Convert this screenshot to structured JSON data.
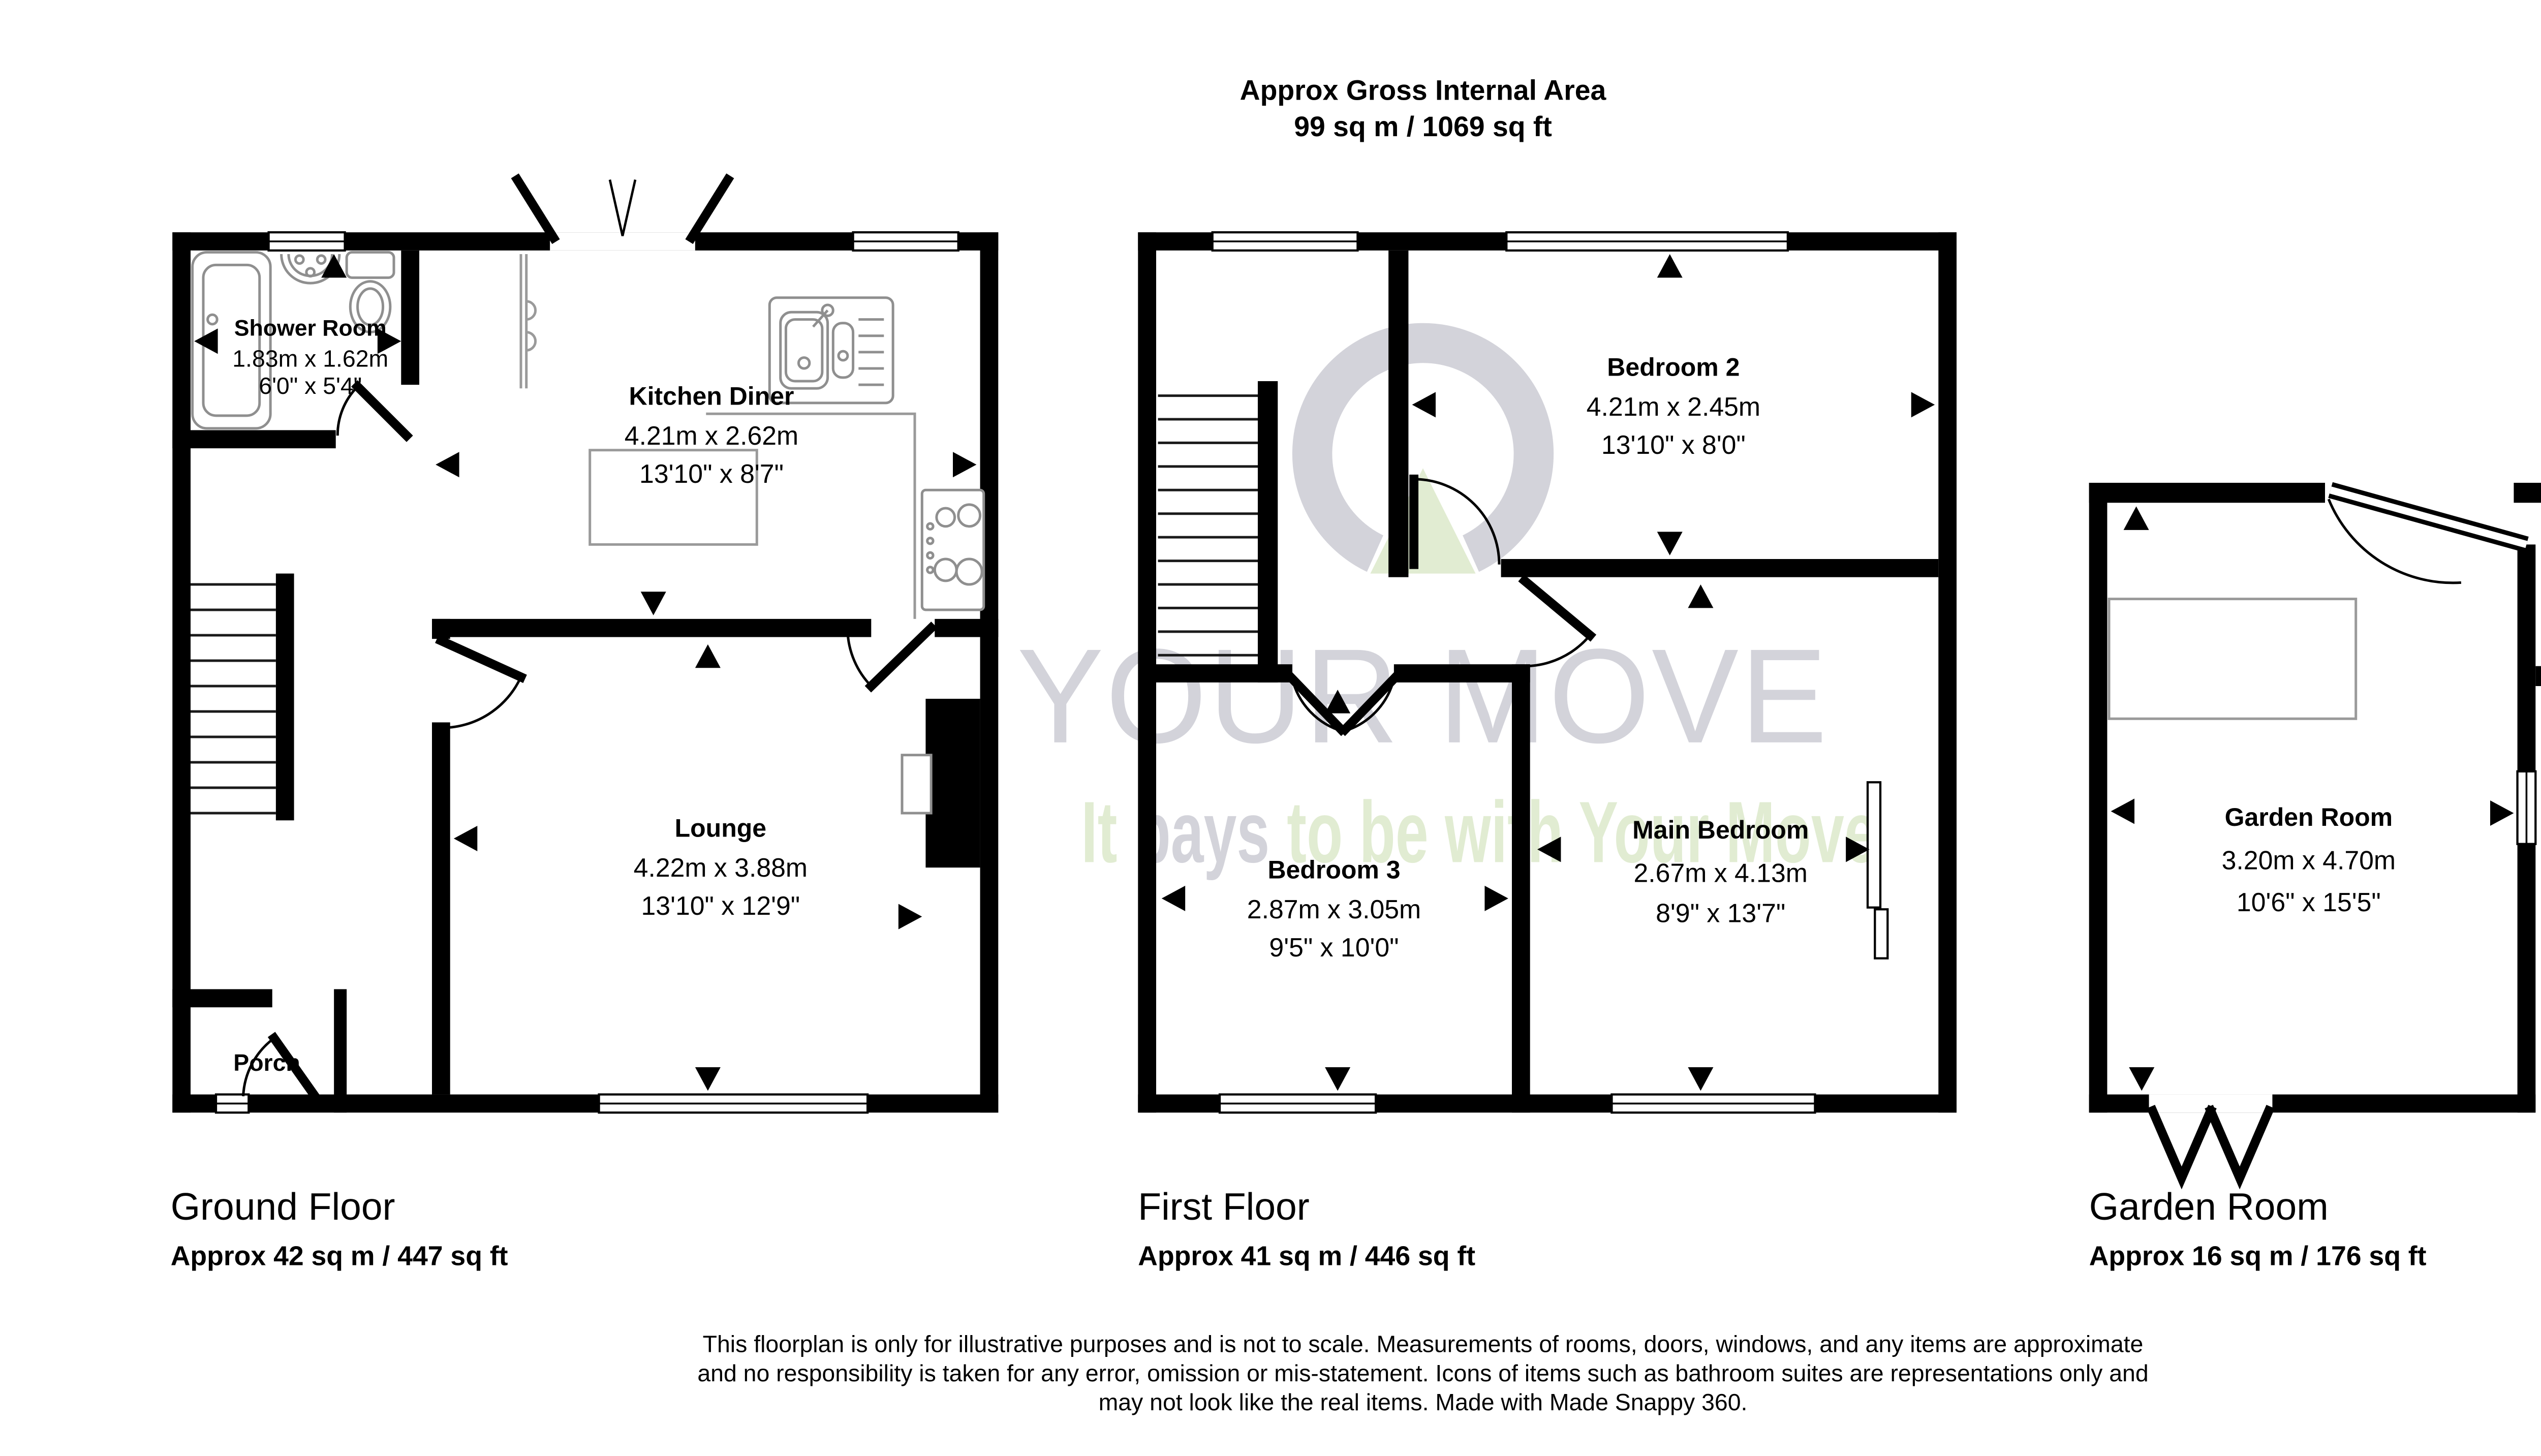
{
  "title": {
    "line1": "Approx Gross Internal Area",
    "line2": "99 sq m / 1069 sq ft"
  },
  "watermark": {
    "brand": "YOUR MOVE",
    "slogan_word1": "It",
    "slogan_word2": "pays",
    "slogan_word3": "to be with Your Move",
    "logo": "your-move-logo",
    "colors": {
      "gray": "#d3d3da",
      "green": "#e1ecd2"
    }
  },
  "rooms": {
    "shower": {
      "name": "Shower Room",
      "metric": "1.83m x 1.62m",
      "imperial": "6'0\" x 5'4\""
    },
    "kitchen": {
      "name": "Kitchen Diner",
      "metric": "4.21m x 2.62m",
      "imperial": "13'10\" x 8'7\""
    },
    "lounge": {
      "name": "Lounge",
      "metric": "4.22m x 3.88m",
      "imperial": "13'10\" x 12'9\""
    },
    "porch": {
      "name": "Porch"
    },
    "bedroom2": {
      "name": "Bedroom 2",
      "metric": "4.21m x 2.45m",
      "imperial": "13'10\" x 8'0\""
    },
    "bedroom3": {
      "name": "Bedroom 3",
      "metric": "2.87m x 3.05m",
      "imperial": "9'5\" x 10'0\""
    },
    "main_bedroom": {
      "name": "Main Bedroom",
      "metric": "2.67m x 4.13m",
      "imperial": "8'9\" x 13'7\""
    },
    "garden_room": {
      "name": "Garden Room",
      "metric": "3.20m x 4.70m",
      "imperial": "10'6\" x 15'5\""
    },
    "storage": {
      "line1": "Storage",
      "line2": "Room"
    }
  },
  "floors": {
    "ground": {
      "label": "Ground Floor",
      "area": "Approx 42 sq m / 447 sq ft"
    },
    "first": {
      "label": "First Floor",
      "area": "Approx 41 sq m / 446 sq ft"
    },
    "garden": {
      "label": "Garden Room",
      "area": "Approx 16 sq m / 176 sq ft"
    }
  },
  "disclaimer": {
    "line1": "This floorplan is only for illustrative purposes and is not to scale. Measurements of rooms, doors, windows, and any items are approximate",
    "line2": "and no responsibility is taken for any error, omission or mis-statement. Icons of items such as bathroom suites are representations only and",
    "line3": "may not look like the real items. Made with Made Snappy 360."
  },
  "icons": [
    "bath-icon",
    "basin-icon",
    "toilet-icon",
    "kitchen-sink-icon",
    "hob-icon",
    "stairs-icon",
    "door-arc-icon",
    "window-icon",
    "measure-arrow-icon",
    "your-move-logo"
  ],
  "colors": {
    "wall": "#000000",
    "fixture_gray": "#8f8f8f",
    "counter_gray": "#9a9a9a",
    "watermark_gray": "#d3d3da",
    "watermark_green": "#e1ecd2"
  }
}
